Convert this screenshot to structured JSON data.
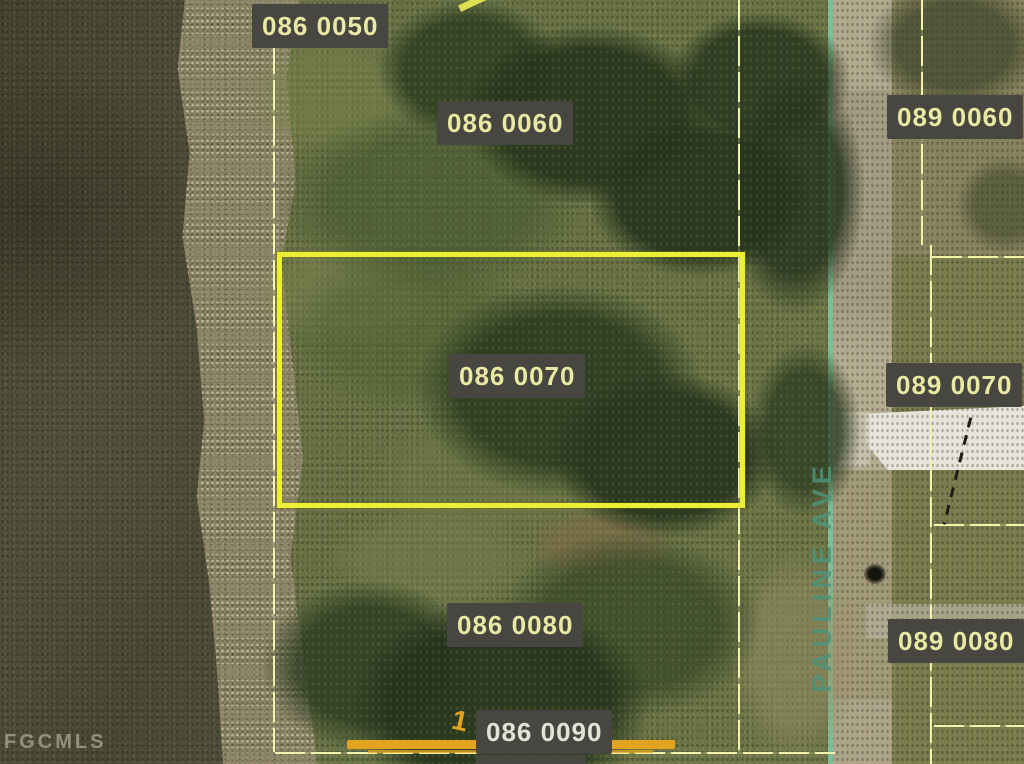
{
  "map": {
    "watermark": "FGCMLS",
    "street": {
      "name": "PAULINE AVE"
    },
    "highlighted_parcel": "086 0070",
    "dimension_mark": "1",
    "parcels_west": [
      {
        "label": "086 0050"
      },
      {
        "label": "086 0060"
      },
      {
        "label": "086 0070"
      },
      {
        "label": "086 0080"
      },
      {
        "label": "086 0090"
      }
    ],
    "parcels_east": [
      {
        "label": "089 0060"
      },
      {
        "label": "089 0070"
      },
      {
        "label": "089 0080"
      }
    ],
    "colors": {
      "highlight_border": "#edef36",
      "parcel_line": "#f2f2ac",
      "street_line": "#7cc6a4",
      "street_text": "#4f937a",
      "label_bg": "#484640",
      "label_text": "#e9e9a3",
      "label_text_light": "#e2e5d6",
      "orange_bar": "#e2a41f"
    }
  }
}
